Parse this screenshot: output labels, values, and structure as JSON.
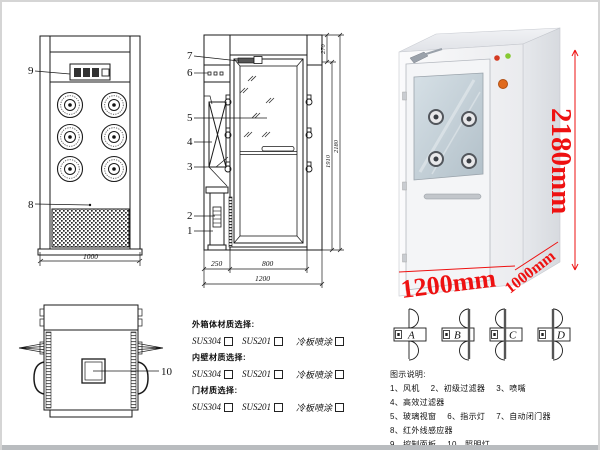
{
  "page": {
    "background": "#ffffff",
    "border_color": "#d5d5d5",
    "dimension_color": "#ee1111",
    "line_color": "#1a1a1a"
  },
  "front_view": {
    "callout_9": "9",
    "callout_8": "8",
    "dim_width": "1000"
  },
  "side_view": {
    "callouts": [
      "7",
      "6",
      "5",
      "4",
      "3",
      "2",
      "1"
    ],
    "dim_left": "250",
    "dim_door": "800",
    "dim_total_width": "1200",
    "dim_top": "270",
    "dim_door_height": "1910",
    "dim_total_height": "2180"
  },
  "top_view": {
    "callout_10": "10"
  },
  "photo": {
    "dim_height": "2180mm",
    "dim_width": "1200mm",
    "dim_depth": "1000mm",
    "body_color": "#f2f3f5",
    "glass_color": "#c4d1d9"
  },
  "door_types": {
    "labels": [
      "A",
      "B",
      "C",
      "D"
    ]
  },
  "materials": {
    "sections": [
      {
        "title": "外箱体材质选择:",
        "options": [
          "SUS304",
          "SUS201",
          "冷板喷涂"
        ]
      },
      {
        "title": "内壁材质选择:",
        "options": [
          "SUS304",
          "SUS201",
          "冷板喷涂"
        ]
      },
      {
        "title": "门材质选择:",
        "options": [
          "SUS304",
          "SUS201",
          "冷板喷涂"
        ]
      }
    ]
  },
  "legend": {
    "title": "图示说明:",
    "rows": [
      [
        "1、风机",
        "2、初级过滤器",
        "3、喷嘴",
        "4、高效过滤器"
      ],
      [
        "5、玻璃视窗",
        "6、指示灯",
        "7、自动闭门器",
        "8、红外线感应器"
      ],
      [
        "9、控制面板",
        "10、照明灯"
      ]
    ]
  }
}
